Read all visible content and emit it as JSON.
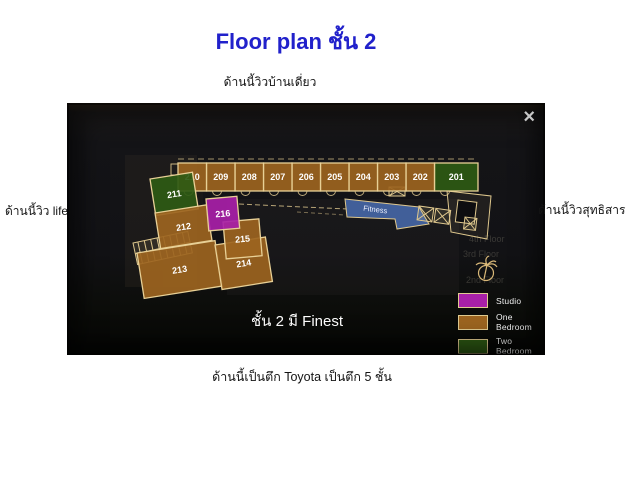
{
  "page": {
    "title": "Floor plan ชั้น 2",
    "title_color": "#2121cb",
    "captions": {
      "top": "ด้านนี้วิวบ้านเดี่ยว",
      "left": "ด้านนี้วิว life",
      "right": "ด้านนี้วิวสุทธิสาร",
      "bottom": "ด้านนี้เป็นตึก Toyota เป็นตึก 5 ชั้น"
    }
  },
  "lightbox": {
    "close_label": "×",
    "overlay_text": "ชั้น 2 มี Finest"
  },
  "floorplan": {
    "fitness_label": "Fitness",
    "fitness_color": "#4a6fb5",
    "rooms": [
      {
        "number": "201",
        "type": "two_bedroom"
      },
      {
        "number": "202",
        "type": "one_bedroom"
      },
      {
        "number": "203",
        "type": "one_bedroom"
      },
      {
        "number": "204",
        "type": "one_bedroom"
      },
      {
        "number": "205",
        "type": "one_bedroom"
      },
      {
        "number": "206",
        "type": "one_bedroom"
      },
      {
        "number": "207",
        "type": "one_bedroom"
      },
      {
        "number": "208",
        "type": "one_bedroom"
      },
      {
        "number": "209",
        "type": "one_bedroom"
      },
      {
        "number": "210",
        "type": "one_bedroom"
      },
      {
        "number": "211",
        "type": "two_bedroom"
      },
      {
        "number": "212",
        "type": "one_bedroom"
      },
      {
        "number": "213",
        "type": "one_bedroom"
      },
      {
        "number": "214",
        "type": "one_bedroom"
      },
      {
        "number": "215",
        "type": "one_bedroom"
      },
      {
        "number": "216",
        "type": "studio"
      }
    ],
    "legend": {
      "items": [
        {
          "label": "Studio",
          "type": "studio",
          "color": "#a820a8"
        },
        {
          "label": "One Bedroom",
          "type": "one_bedroom",
          "color": "#9c6420"
        },
        {
          "label": "Two Bedroom",
          "type": "two_bedroom",
          "color": "#2e5a14"
        }
      ]
    },
    "background_floor_labels": [
      "4th Floor",
      "3rd Floor",
      "2nd Floor"
    ]
  }
}
